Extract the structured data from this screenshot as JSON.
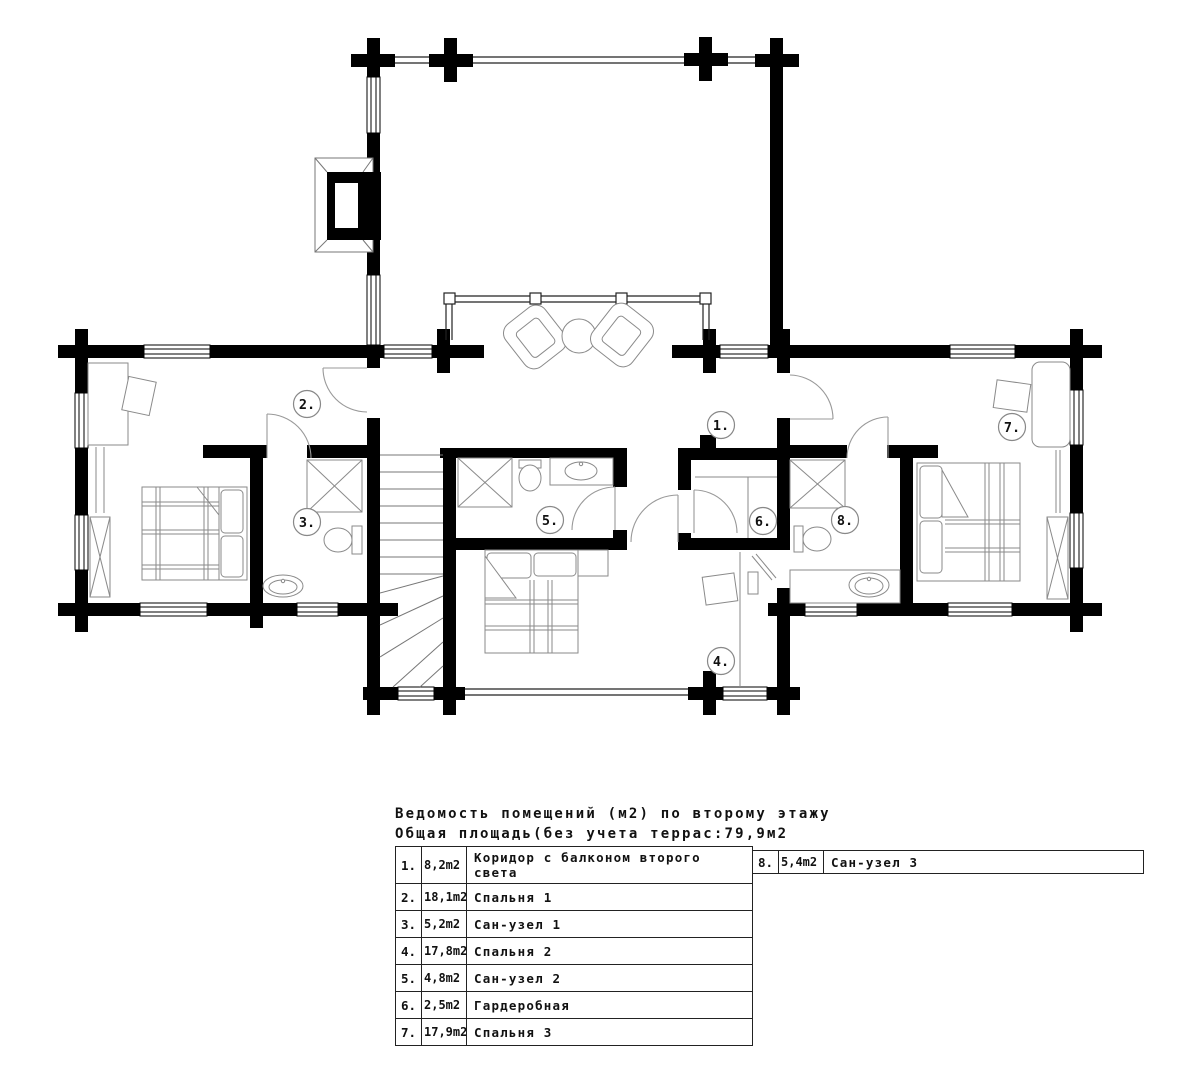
{
  "plan": {
    "labels": [
      "1.",
      "2.",
      "3.",
      "4.",
      "5.",
      "6.",
      "7.",
      "8."
    ]
  },
  "schedule": {
    "title": "Ведомость помещений (м2) по второму этажу",
    "subtitle": "Общая площадь(без учета террас:79,9м2",
    "left_rows": [
      {
        "num": "1.",
        "area": "8,2m2",
        "name": "Коридор с балконом второго света"
      },
      {
        "num": "2.",
        "area": "18,1m2",
        "name": "Спальня 1"
      },
      {
        "num": "3.",
        "area": "5,2m2",
        "name": "Сан-узел 1"
      },
      {
        "num": "4.",
        "area": "17,8m2",
        "name": "Спальня 2"
      },
      {
        "num": "5.",
        "area": "4,8m2",
        "name": "Сан-узел 2"
      },
      {
        "num": "6.",
        "area": "2,5m2",
        "name": "Гардеробная"
      },
      {
        "num": "7.",
        "area": "17,9m2",
        "name": "Спальня 3"
      }
    ],
    "right_rows": [
      {
        "num": "8.",
        "area": "5,4m2",
        "name": "Сан-узел 3"
      }
    ]
  }
}
